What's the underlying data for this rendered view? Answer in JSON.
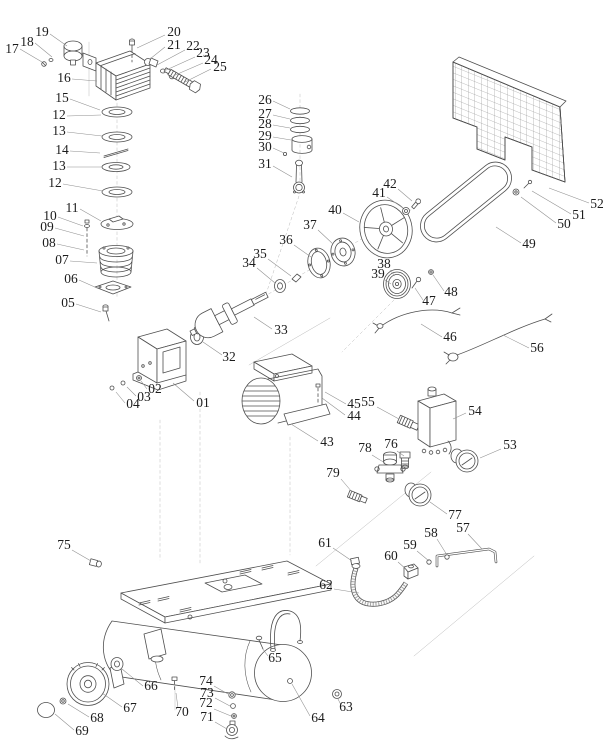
{
  "diagram": {
    "alt": "Exploded-view parts diagram of a belt-driven air compressor",
    "canvas": {
      "width": 615,
      "height": 755
    },
    "colors": {
      "line": "#4f4f4f",
      "leader": "#8f8f8f",
      "label": "#1c1c1c",
      "background": "#ffffff"
    },
    "label_font_size": 13.5,
    "parts": [
      {
        "n": "17",
        "x": 12,
        "y": 53,
        "l": [
          20,
          49,
          42,
          62
        ]
      },
      {
        "n": "18",
        "x": 27,
        "y": 46,
        "l": [
          35,
          43,
          52,
          57
        ]
      },
      {
        "n": "19",
        "x": 42,
        "y": 36,
        "l": [
          50,
          34,
          67,
          46
        ]
      },
      {
        "n": "20",
        "x": 174,
        "y": 36,
        "l": [
          165,
          35,
          137,
          48
        ]
      },
      {
        "n": "21",
        "x": 174,
        "y": 49,
        "l": [
          165,
          47,
          150,
          59
        ]
      },
      {
        "n": "22",
        "x": 193,
        "y": 50,
        "l": [
          185,
          50,
          157,
          65
        ]
      },
      {
        "n": "23",
        "x": 203,
        "y": 57,
        "l": [
          195,
          57,
          164,
          71
        ]
      },
      {
        "n": "24",
        "x": 211,
        "y": 64,
        "l": [
          203,
          63,
          173,
          76
        ]
      },
      {
        "n": "25",
        "x": 220,
        "y": 71,
        "l": [
          211,
          69,
          185,
          82
        ]
      },
      {
        "n": "16",
        "x": 64,
        "y": 82,
        "l": [
          72,
          79,
          97,
          81
        ]
      },
      {
        "n": "15",
        "x": 62,
        "y": 102,
        "l": [
          70,
          99,
          100,
          110
        ]
      },
      {
        "n": "12",
        "x": 59,
        "y": 119,
        "l": [
          67,
          116,
          101,
          115
        ]
      },
      {
        "n": "13",
        "x": 59,
        "y": 135,
        "l": [
          67,
          132,
          102,
          136
        ]
      },
      {
        "n": "14",
        "x": 62,
        "y": 154,
        "l": [
          70,
          151,
          100,
          153
        ]
      },
      {
        "n": "13",
        "x": 59,
        "y": 170,
        "l": [
          67,
          167,
          102,
          167
        ]
      },
      {
        "n": "12",
        "x": 55,
        "y": 187,
        "l": [
          63,
          184,
          103,
          191
        ]
      },
      {
        "n": "26",
        "x": 265,
        "y": 104,
        "l": [
          273,
          101,
          290,
          109
        ]
      },
      {
        "n": "27",
        "x": 265,
        "y": 118,
        "l": [
          273,
          115,
          290,
          119
        ]
      },
      {
        "n": "28",
        "x": 265,
        "y": 128,
        "l": [
          273,
          125,
          290,
          128
        ]
      },
      {
        "n": "29",
        "x": 265,
        "y": 140,
        "l": [
          273,
          137,
          291,
          140
        ]
      },
      {
        "n": "30",
        "x": 265,
        "y": 151,
        "l": [
          273,
          148,
          284,
          153
        ]
      },
      {
        "n": "31",
        "x": 265,
        "y": 168,
        "l": [
          273,
          166,
          292,
          177
        ]
      },
      {
        "n": "11",
        "x": 72,
        "y": 212,
        "l": [
          80,
          209,
          101,
          221
        ]
      },
      {
        "n": "10",
        "x": 50,
        "y": 220,
        "l": [
          58,
          217,
          83,
          226
        ]
      },
      {
        "n": "09",
        "x": 47,
        "y": 231,
        "l": [
          55,
          228,
          84,
          236
        ]
      },
      {
        "n": "08",
        "x": 49,
        "y": 247,
        "l": [
          57,
          244,
          84,
          250
        ]
      },
      {
        "n": "07",
        "x": 62,
        "y": 264,
        "l": [
          70,
          261,
          97,
          263
        ]
      },
      {
        "n": "06",
        "x": 71,
        "y": 283,
        "l": [
          79,
          280,
          97,
          288
        ]
      },
      {
        "n": "05",
        "x": 68,
        "y": 307,
        "l": [
          76,
          304,
          101,
          312
        ]
      },
      {
        "n": "01",
        "x": 203,
        "y": 407,
        "l": [
          194,
          401,
          173,
          383
        ]
      },
      {
        "n": "02",
        "x": 155,
        "y": 393,
        "l": [
          147,
          389,
          141,
          381
        ]
      },
      {
        "n": "03",
        "x": 144,
        "y": 401,
        "l": [
          136,
          396,
          127,
          387
        ]
      },
      {
        "n": "04",
        "x": 133,
        "y": 408,
        "l": [
          125,
          403,
          116,
          392
        ]
      },
      {
        "n": "32",
        "x": 229,
        "y": 361,
        "l": [
          222,
          355,
          203,
          342
        ]
      },
      {
        "n": "33",
        "x": 281,
        "y": 334,
        "l": [
          272,
          329,
          254,
          317
        ]
      },
      {
        "n": "34",
        "x": 249,
        "y": 267,
        "l": [
          257,
          268,
          275,
          283
        ]
      },
      {
        "n": "35",
        "x": 260,
        "y": 258,
        "l": [
          268,
          259,
          291,
          276
        ]
      },
      {
        "n": "36",
        "x": 286,
        "y": 244,
        "l": [
          294,
          245,
          311,
          257
        ]
      },
      {
        "n": "37",
        "x": 310,
        "y": 229,
        "l": [
          318,
          230,
          333,
          244
        ]
      },
      {
        "n": "40",
        "x": 335,
        "y": 214,
        "l": [
          343,
          213,
          359,
          222
        ]
      },
      {
        "n": "41",
        "x": 379,
        "y": 197,
        "l": [
          387,
          197,
          403,
          208
        ]
      },
      {
        "n": "42",
        "x": 390,
        "y": 188,
        "l": [
          398,
          189,
          412,
          201
        ]
      },
      {
        "n": "38",
        "x": 384,
        "y": 268,
        "l": [
          390,
          270,
          395,
          276
        ]
      },
      {
        "n": "39",
        "x": 378,
        "y": 278,
        "l": [
          385,
          280,
          391,
          284
        ]
      },
      {
        "n": "47",
        "x": 429,
        "y": 305,
        "l": [
          423,
          300,
          415,
          288
        ]
      },
      {
        "n": "48",
        "x": 451,
        "y": 296,
        "l": [
          444,
          291,
          433,
          275
        ]
      },
      {
        "n": "49",
        "x": 529,
        "y": 248,
        "l": [
          521,
          243,
          496,
          227
        ]
      },
      {
        "n": "50",
        "x": 564,
        "y": 228,
        "l": [
          556,
          223,
          521,
          197
        ]
      },
      {
        "n": "51",
        "x": 579,
        "y": 219,
        "l": [
          571,
          214,
          532,
          191
        ]
      },
      {
        "n": "52",
        "x": 597,
        "y": 208,
        "l": [
          589,
          203,
          549,
          188
        ]
      },
      {
        "n": "46",
        "x": 450,
        "y": 341,
        "l": [
          442,
          337,
          421,
          324
        ]
      },
      {
        "n": "56",
        "x": 537,
        "y": 352,
        "l": [
          529,
          348,
          503,
          335
        ]
      },
      {
        "n": "43",
        "x": 327,
        "y": 446,
        "l": [
          318,
          441,
          291,
          424
        ]
      },
      {
        "n": "44",
        "x": 354,
        "y": 420,
        "l": [
          345,
          415,
          322,
          398
        ]
      },
      {
        "n": "45",
        "x": 354,
        "y": 408,
        "l": [
          346,
          404,
          325,
          392
        ]
      },
      {
        "n": "55",
        "x": 368,
        "y": 406,
        "l": [
          377,
          407,
          399,
          419
        ]
      },
      {
        "n": "54",
        "x": 475,
        "y": 415,
        "l": [
          466,
          413,
          453,
          419
        ]
      },
      {
        "n": "53",
        "x": 510,
        "y": 449,
        "l": [
          501,
          449,
          480,
          458
        ]
      },
      {
        "n": "76",
        "x": 391,
        "y": 448,
        "l": [
          397,
          451,
          404,
          456
        ]
      },
      {
        "n": "78",
        "x": 365,
        "y": 452,
        "l": [
          372,
          455,
          385,
          463
        ]
      },
      {
        "n": "79",
        "x": 333,
        "y": 477,
        "l": [
          341,
          479,
          352,
          492
        ]
      },
      {
        "n": "77",
        "x": 455,
        "y": 519,
        "l": [
          447,
          514,
          430,
          502
        ]
      },
      {
        "n": "57",
        "x": 463,
        "y": 532,
        "l": [
          468,
          534,
          482,
          549
        ]
      },
      {
        "n": "58",
        "x": 431,
        "y": 537,
        "l": [
          437,
          539,
          447,
          555
        ]
      },
      {
        "n": "59",
        "x": 410,
        "y": 549,
        "l": [
          417,
          551,
          429,
          561
        ]
      },
      {
        "n": "60",
        "x": 391,
        "y": 560,
        "l": [
          398,
          562,
          407,
          570
        ]
      },
      {
        "n": "61",
        "x": 325,
        "y": 547,
        "l": [
          333,
          548,
          352,
          561
        ]
      },
      {
        "n": "62",
        "x": 326,
        "y": 589,
        "l": [
          334,
          589,
          359,
          593
        ]
      },
      {
        "n": "75",
        "x": 64,
        "y": 549,
        "l": [
          72,
          550,
          91,
          561
        ]
      },
      {
        "n": "65",
        "x": 275,
        "y": 662,
        "l": [
          268,
          656,
          262,
          648
        ]
      },
      {
        "n": "66",
        "x": 151,
        "y": 690,
        "l": [
          143,
          686,
          122,
          669
        ]
      },
      {
        "n": "67",
        "x": 130,
        "y": 712,
        "l": [
          122,
          707,
          102,
          693
        ]
      },
      {
        "n": "68",
        "x": 97,
        "y": 722,
        "l": [
          89,
          717,
          68,
          704
        ]
      },
      {
        "n": "69",
        "x": 82,
        "y": 735,
        "l": [
          74,
          730,
          55,
          714
        ]
      },
      {
        "n": "70",
        "x": 182,
        "y": 716,
        "l": [
          178,
          708,
          176,
          693
        ]
      },
      {
        "n": "74",
        "x": 206,
        "y": 685,
        "l": [
          214,
          686,
          228,
          694
        ]
      },
      {
        "n": "73",
        "x": 207,
        "y": 697,
        "l": [
          215,
          698,
          230,
          706
        ]
      },
      {
        "n": "72",
        "x": 206,
        "y": 707,
        "l": [
          214,
          709,
          231,
          716
        ]
      },
      {
        "n": "71",
        "x": 207,
        "y": 721,
        "l": [
          215,
          722,
          227,
          729
        ]
      },
      {
        "n": "63",
        "x": 346,
        "y": 711,
        "l": [
          341,
          705,
          338,
          699
        ]
      },
      {
        "n": "64",
        "x": 318,
        "y": 722,
        "l": [
          310,
          716,
          292,
          684
        ]
      }
    ]
  }
}
